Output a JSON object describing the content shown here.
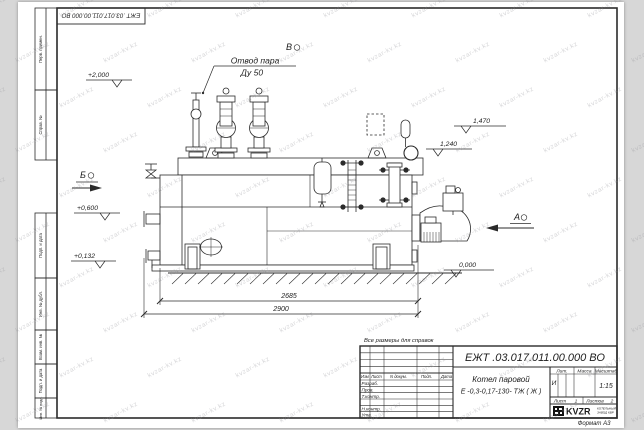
{
  "watermark": "kvzar-kv.kz",
  "frame": {
    "stamp_top": "ЕЖТ .03.017.011.00.000  ВО",
    "left_labels": [
      "Перв. примен.",
      "Справ. №",
      "Подп. и дата",
      "Инв. № дубл.",
      "Взам. инв. №",
      "Подп. и дата",
      "Инв. № подл."
    ],
    "format_note": "Формат А3"
  },
  "drawing": {
    "callout_line1": "Отвод пара",
    "callout_line2": "Ду 50",
    "views": [
      "Б",
      "В",
      "А"
    ],
    "elevations": [
      "+2,000",
      "1,470",
      "1,240",
      "+0,600",
      "+0,132",
      "0,000"
    ],
    "dims": [
      "2685",
      "2900"
    ],
    "note": "Все размеры для справок"
  },
  "title_block": {
    "doc_number": "ЕЖТ .03.017.011.00.000  ВО",
    "product_name": "Котел паровой",
    "product_type": "Е -0,3-0,17-130- ТЖ ( Ж )",
    "header_cols": [
      "Изм",
      "Лист",
      "N докум.",
      "Подп.",
      "Дата"
    ],
    "sign_rows": [
      "Разраб.",
      "Пров.",
      "Т.контр.",
      "Н.контр.",
      "Утв."
    ],
    "lit_label": "Лит.",
    "lit_value": "И",
    "mass_label": "Масса",
    "scale_label": "Масштаб",
    "scale_value": "1:15",
    "sheet_label": "Лист",
    "sheet_value": "1",
    "sheets_label": "Листов",
    "sheets_value": "2",
    "logo_text": "KVZR",
    "logo_sub1": "КОТЕЛЬНЫЙ",
    "logo_sub2": "ЗАВОД КВР"
  }
}
